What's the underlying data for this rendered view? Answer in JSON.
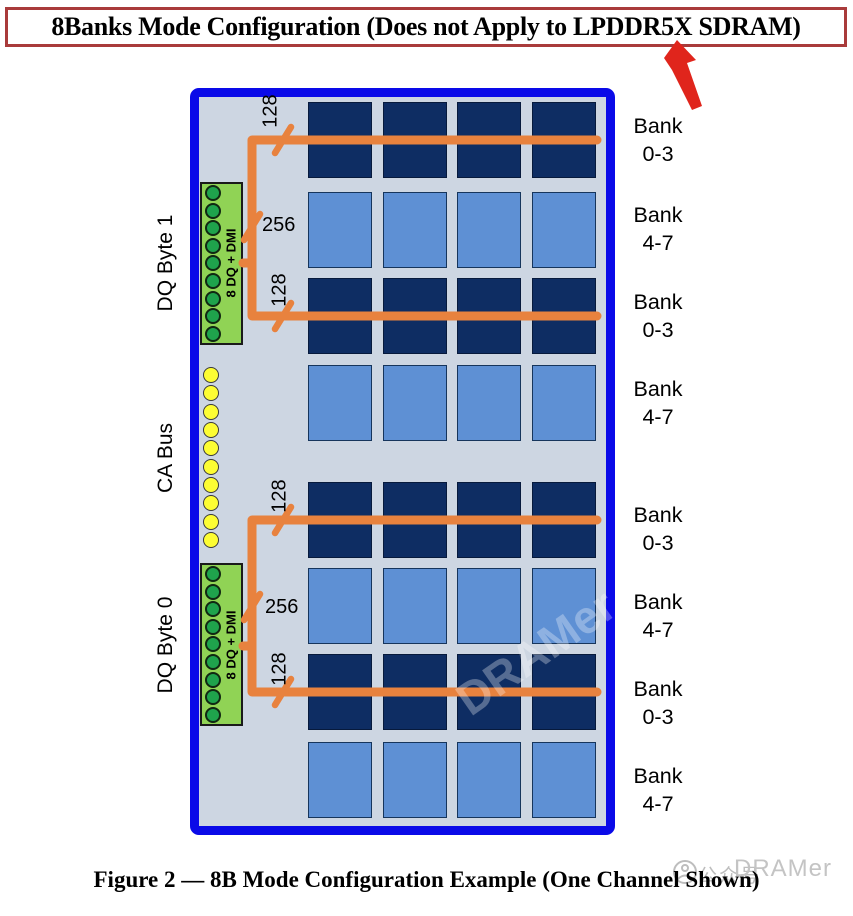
{
  "title": "8Banks Mode Configuration (Does not Apply to LPDDR5X SDRAM)",
  "caption": "Figure 2 — 8B Mode Configuration Example (One Channel Shown)",
  "colors": {
    "title_border": "#a93b3b",
    "arrow_red": "#e0251c",
    "board_border": "#0a0ae8",
    "board_bg": "#cdd6e2",
    "bank_dark": "#0e2d63",
    "bank_dark_border": "#071a3c",
    "bank_light": "#5e90d4",
    "bank_light_border": "#16355c",
    "connector_bg": "#90d355",
    "connector_border": "#1a1a1a",
    "dq_pin": "#1fa34c",
    "ca_pin": "#fdfd33",
    "bus_orange": "#e8823e",
    "watermark_gray": "#bdbdbd"
  },
  "side_labels": {
    "dq_byte_1": "DQ Byte 1",
    "ca_bus": "CA Bus",
    "dq_byte_0": "DQ Byte 0"
  },
  "connector_label": "8 DQ + DMI",
  "dq_pins_per_connector": 9,
  "ca_pins": 10,
  "bus_widths": {
    "byte_lane": "128",
    "combined": "256"
  },
  "grid_cols": 4,
  "bank_rows": [
    {
      "type": "dark",
      "label": [
        "Bank",
        "0-3"
      ]
    },
    {
      "type": "light",
      "label": [
        "Bank",
        "4-7"
      ]
    },
    {
      "type": "dark",
      "label": [
        "Bank",
        "0-3"
      ]
    },
    {
      "type": "light",
      "label": [
        "Bank",
        "4-7"
      ]
    },
    {
      "type": "dark",
      "label": [
        "Bank",
        "0-3"
      ]
    },
    {
      "type": "light",
      "label": [
        "Bank",
        "4-7"
      ]
    },
    {
      "type": "dark",
      "label": [
        "Bank",
        "0-3"
      ]
    },
    {
      "type": "light",
      "label": [
        "Bank",
        "4-7"
      ]
    }
  ],
  "watermark": {
    "icon": "wechat-official-account-icon",
    "cn": "公众号",
    "en": "DRAMer"
  }
}
